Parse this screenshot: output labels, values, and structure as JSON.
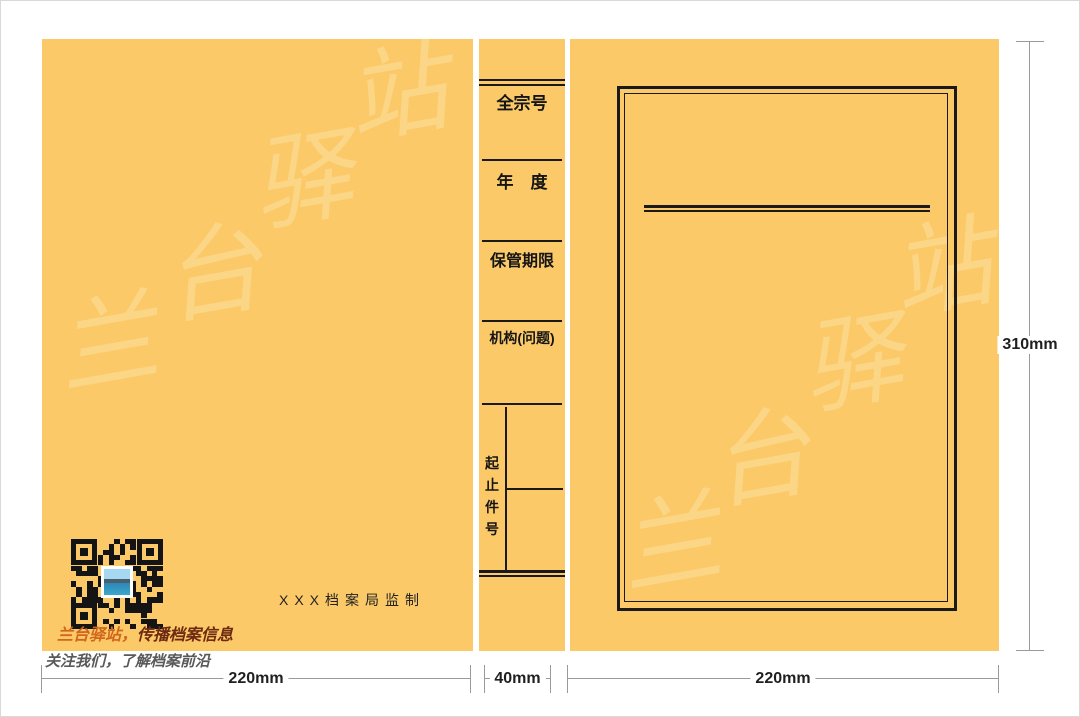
{
  "colors": {
    "panel": "#fbc968",
    "ink_line": "#1a1a1a",
    "watermark": "#fcd687",
    "dimension_line": "#9a9a9a",
    "dimension_text": "#1f1f1f",
    "slogan_accent": "#d2661c",
    "slogan_dark": "#6d2a12",
    "slogan_gray": "#595959"
  },
  "spine": {
    "fields": [
      {
        "label": "全宗号"
      },
      {
        "label": "年　度"
      },
      {
        "label": "保管期限"
      },
      {
        "label": "机构(问题)"
      },
      {
        "label": "起止件号"
      }
    ]
  },
  "back_cover": {
    "publisher": "XXX档案局监制",
    "slogan_accent": "兰台驿站，",
    "slogan_main": "传播档案信息",
    "slogan_sub": "关注我们，了解档案前沿",
    "qr_icon": "qr-code"
  },
  "dimensions": {
    "back_width": "220mm",
    "spine_width": "40mm",
    "front_width": "220mm",
    "height": "310mm"
  },
  "watermark": {
    "chars": [
      "兰",
      "台",
      "驿",
      "站"
    ]
  }
}
